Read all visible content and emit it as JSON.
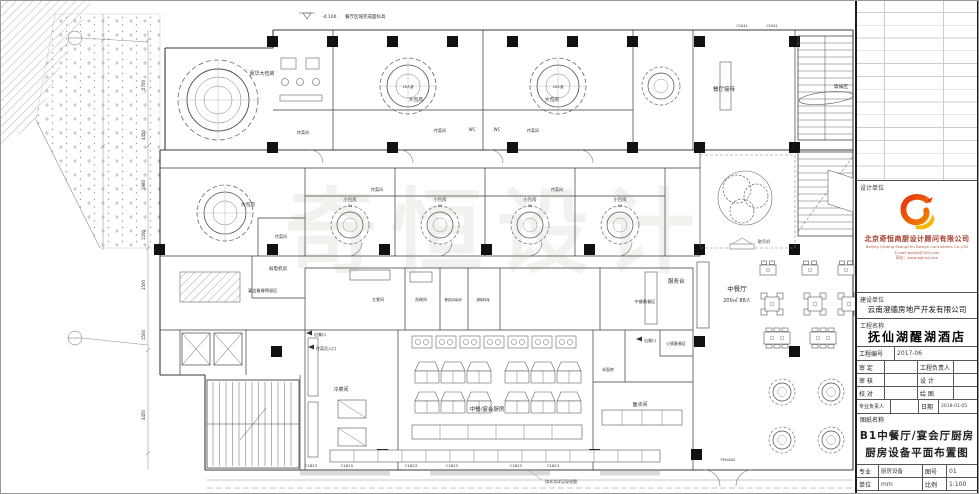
{
  "watermark": "奇恒设计",
  "plan": {
    "elevation": "-4.100",
    "elevation_note": "餐厅区域完成面标高",
    "rooms": {
      "luxury_private": "豪华大包房",
      "reception": "餐厅接待",
      "waiting": "等候区",
      "big_private": "大包房",
      "pass_room": "传菜间",
      "wc": "WC",
      "small_private": "小包房",
      "weak_power": "弱电机房",
      "reserve": "宴会备餐预留区",
      "service_desk": "服务台",
      "dining": "中餐厅",
      "dining_info": "200㎡ 88人",
      "prep_chinese": "中餐备餐区",
      "prep_hotpot": "火锅备餐区",
      "cold_room": "冷菜间",
      "staple_room": "主食间",
      "dishwash_room": "洗碗间",
      "disinfect_room": "餐具消毒间",
      "seasoning_room": "调味料库",
      "rice_store": "米面库",
      "pastry_room": "面点间",
      "main_kitchen": "中餐/宴会厨房",
      "ticket_machine": "取号机",
      "table_16": "16人桌",
      "meal_out": "出餐口",
      "staff_entry": "传菜员入口",
      "drain_note": "排水沟详见深化图"
    },
    "small_nums": [
      "01",
      "02",
      "03",
      "04"
    ],
    "codes": [
      "C1823",
      "C1815",
      "C1823",
      "C1823",
      "C1823",
      "C1823"
    ],
    "top_codes": [
      "C1041",
      "C1041"
    ],
    "door_code": "FM1842",
    "dims": [
      "5700",
      "4450",
      "1980",
      "1200",
      "1500",
      "1500",
      "4450"
    ]
  },
  "title_block": {
    "design_unit_label": "设计单位",
    "company_cn": "北京奇恒商厨设计顾问有限公司",
    "company_en": "Beijing QiHeng ShangChu Design Consultants Co.,LTD",
    "company_email": "E-mail:bjqhsj@163.com",
    "company_web": "网址：www.bjqhsj.com",
    "client_label": "建设单位",
    "client_name": "云南澄德房地产开发有限公司",
    "project_label": "工程名称",
    "project_name": "抚仙湖醒湖酒店",
    "project_no_label": "工程编号",
    "project_no": "2017-06",
    "approve_label": "审 定",
    "check_label": "审 核",
    "proof_label": "校 对",
    "pm_label": "工程负责人",
    "design_label": "设 计",
    "draft_label": "绘 图",
    "lead_label": "专业负责人",
    "date_label": "日期",
    "date": "2018-01-05",
    "drawing_label": "图纸名称",
    "drawing_name_1": "B1中餐厅/宴会厅厨房",
    "drawing_name_2": "厨房设备平面布置图",
    "major_label": "专业",
    "major": "厨房设备",
    "sheet_no_label": "图号",
    "sheet_no": "01",
    "unit_label": "单位",
    "unit": "mm",
    "scale_label": "比例",
    "scale": "1:100"
  }
}
